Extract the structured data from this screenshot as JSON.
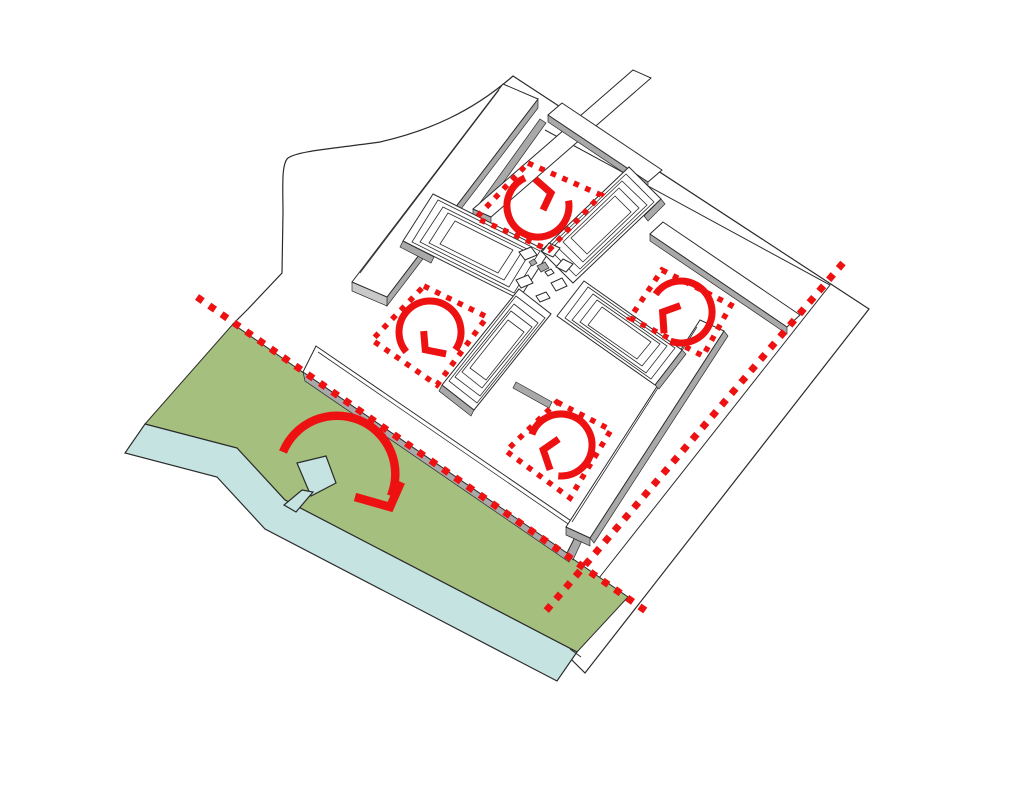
{
  "diagram": {
    "type": "architectural axonometric site circulation diagram",
    "background": "#ffffff",
    "colors": {
      "line": "#2b2b2b",
      "red": "#ee1111",
      "green": "#a5bf7e",
      "water": "#c4e3e1",
      "gray": "#a9a9a9",
      "gray_light": "#c9c9c9"
    },
    "site": {
      "boundary": "irregular parcel, straight north-east and south-east edges, curved north-west edge",
      "setback_lines": 1
    },
    "buildings": {
      "cross_wings": 4,
      "center_pavilions": 9,
      "perimeter_slabs": 6
    },
    "courtyards": [
      {
        "id": "north",
        "marker": "red-dotted-square",
        "symbol": "circulation-loop-arrow"
      },
      {
        "id": "east",
        "marker": "red-dotted-square",
        "symbol": "circulation-loop-arrow"
      },
      {
        "id": "south",
        "marker": "red-dotted-square",
        "symbol": "circulation-loop-arrow"
      },
      {
        "id": "west",
        "marker": "red-dotted-square",
        "symbol": "circulation-loop-arrow"
      }
    ],
    "landscape": {
      "park": {
        "symbol": "large-red-sweep-arrow",
        "features": [
          "kite-shaped-pond",
          "canal-to-river"
        ]
      },
      "river": "light blue band along the south-west edge of the park"
    },
    "dotted_axes": [
      {
        "id": "northwest-axis",
        "from": [
          197,
          297
        ],
        "to": [
          646,
          611
        ]
      },
      {
        "id": "northeast-axis",
        "from": [
          843,
          263
        ],
        "to": [
          545,
          612
        ]
      }
    ]
  }
}
